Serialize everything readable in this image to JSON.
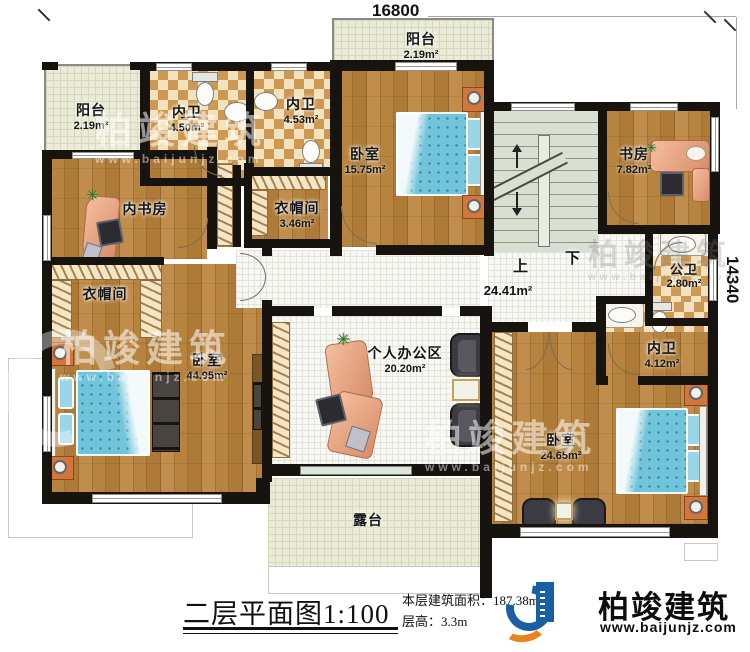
{
  "meta": {
    "drawing_title": "二层平面图",
    "scale": "1:100",
    "floor_area_label": "本层建筑面积：",
    "floor_area_value": "187.38m²",
    "floor_height_label": "层高：",
    "floor_height_value": "3.3m"
  },
  "dims": {
    "top": "16800",
    "right": "14340"
  },
  "stairs": {
    "up": "上",
    "down": "下"
  },
  "hall": {
    "area": "24.41m²"
  },
  "rooms": {
    "balcony_tl": {
      "name": "阳台",
      "area": "2.19m²"
    },
    "bath_a": {
      "name": "内卫",
      "area": "4.50m²"
    },
    "bath_b": {
      "name": "内卫",
      "area": "4.53m²"
    },
    "balcony_tc": {
      "name": "阳台",
      "area": "2.19m²"
    },
    "bedroom_a": {
      "name": "卧室",
      "area": "15.75m²"
    },
    "study": {
      "name": "书房",
      "area": "7.82m²"
    },
    "inner_study": {
      "name": "内书房"
    },
    "cloak_a": {
      "name": "衣帽间",
      "area": "3.46m²"
    },
    "cloak_b": {
      "name": "衣帽间"
    },
    "master_bedroom": {
      "name": "卧室",
      "area": "44.95m²"
    },
    "office": {
      "name": "个人办公区",
      "area": "20.20m²"
    },
    "pub_bath": {
      "name": "公卫",
      "area": "2.80m²"
    },
    "bath_c": {
      "name": "内卫",
      "area": "4.12m²"
    },
    "bedroom_b": {
      "name": "卧室",
      "area": "24.65m²"
    },
    "terrace": {
      "name": "露台"
    }
  },
  "brand": {
    "name": "柏竣建筑",
    "url": "www.baijunjz.com"
  },
  "watermark": {
    "text": "柏竣建筑",
    "url": "www.baijunjz.com"
  }
}
